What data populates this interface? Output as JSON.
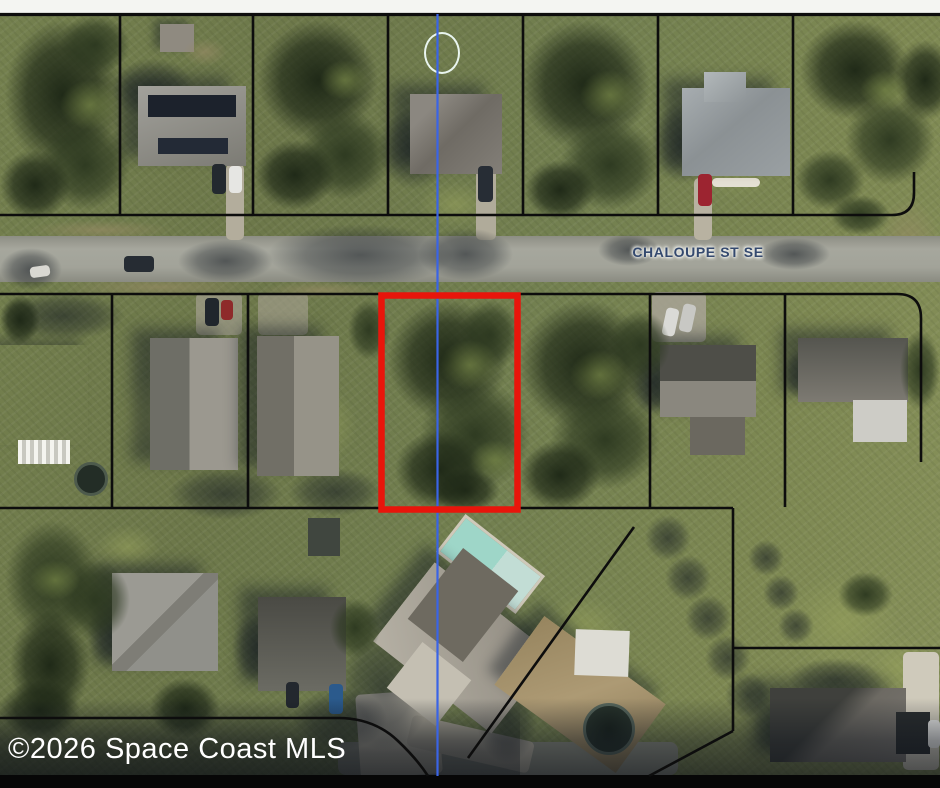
{
  "map": {
    "street_label": "CHALOUPE ST SE",
    "watermark": "©2026 Space Coast MLS"
  },
  "colors": {
    "property_outline_red": "#e8150b",
    "parcel_boundary_black": "#0d0d0d",
    "section_line_blue": "#3a64e6",
    "street_label_text": "#34496e",
    "watermark_text": "#ffffff",
    "road_gray": "#a2a399",
    "top_strip": "#f4f5f2",
    "bottom_bar": "#070707"
  }
}
